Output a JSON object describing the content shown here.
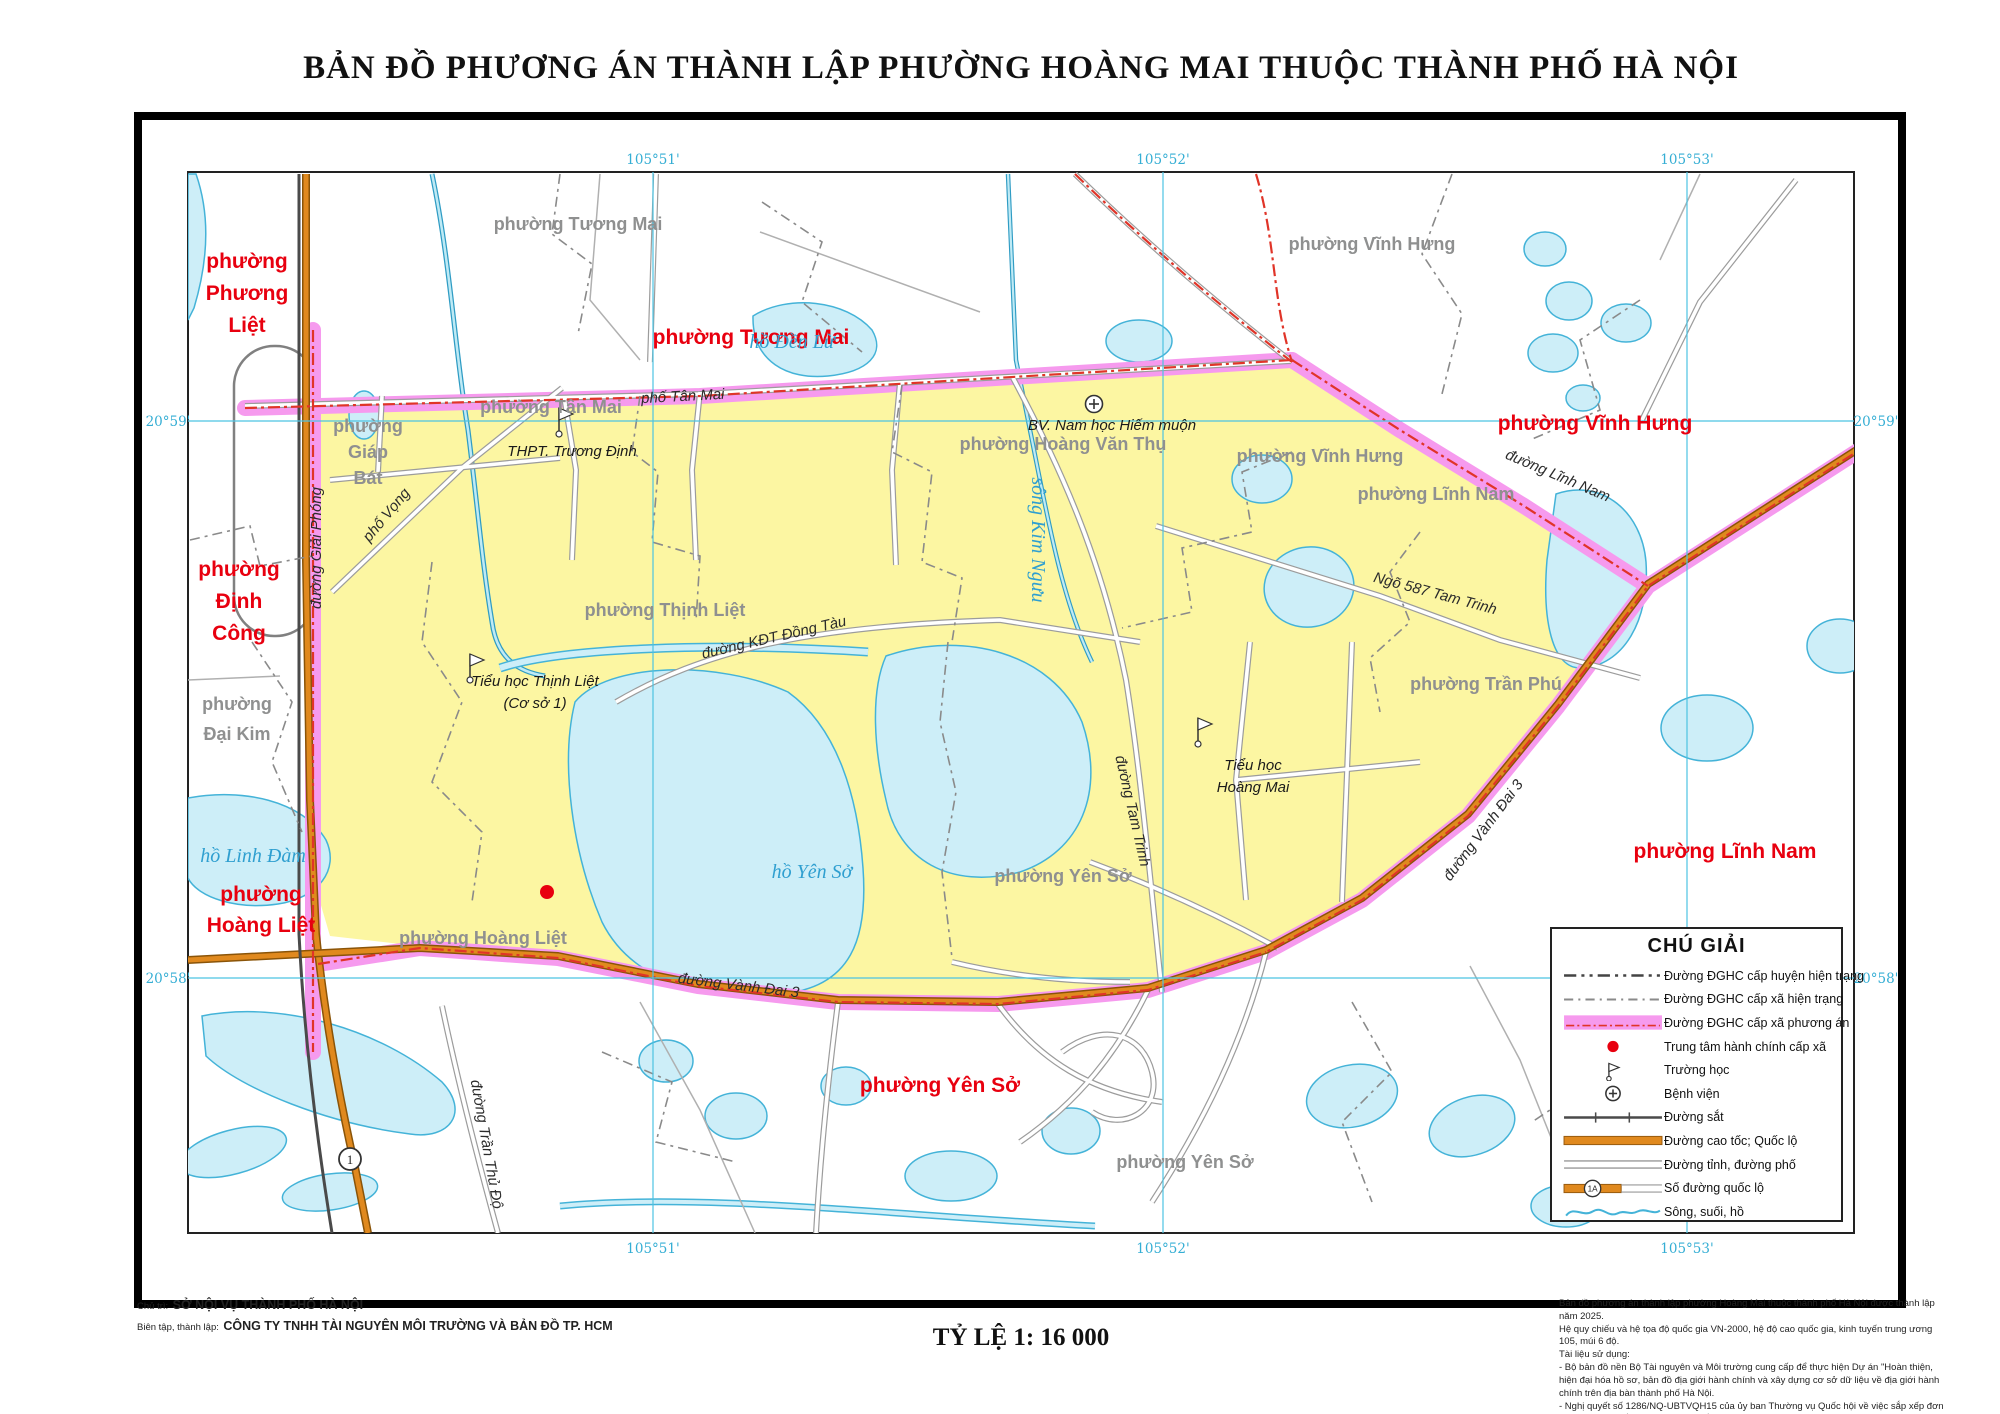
{
  "title": "BẢN ĐỒ PHƯƠNG ÁN THÀNH LẬP PHƯỜNG HOÀNG MAI THUỘC THÀNH PHỐ HÀ NỘI",
  "scale_label": "TỶ LỆ 1: 16 000",
  "credits": {
    "role1_label": "Chủ trì:",
    "role1_value": "SỞ NỘI VỤ THÀNH PHỐ HÀ NỘI",
    "role2_label": "Biên tập, thành lập:",
    "role2_value": "CÔNG TY TNHH TÀI NGUYÊN MÔI TRƯỜNG VÀ BẢN ĐỒ TP. HCM"
  },
  "notes": [
    "Bản đồ phương án thành lập phường Hoàng Mai thuộc thành phố Hà Nội được thành lập năm 2025.",
    "Hệ quy chiếu và hệ tọa độ quốc gia VN-2000, hệ độ cao quốc gia, kinh tuyến trung ương 105, múi 6 độ.",
    "Tài liệu sử dụng:",
    "- Bộ bản đồ nền Bộ Tài nguyên và Môi trường cung cấp để thực hiện Dự án \"Hoàn thiện, hiện đại hóa hồ sơ, bản đồ địa giới hành chính và xây dựng cơ sở dữ liệu về địa giới hành chính trên địa bàn thành phố Hà Nội.",
    "- Nghị quyết số 1286/NQ-UBTVQH15 của ủy ban Thường vụ Quốc hội về việc sắp xếp đơn vị hành chính cấp xã của thành phố Hà Nội giai đoạn 2023 - 2025."
  ],
  "legend": {
    "title": "CHÚ GIẢI",
    "items": [
      {
        "type": "dash_huyen",
        "label": "Đường ĐGHC cấp huyện hiện trạng"
      },
      {
        "type": "dash_xa",
        "label": "Đường ĐGHC cấp xã hiện trạng"
      },
      {
        "type": "pink_band",
        "label": "Đường ĐGHC cấp xã phương án"
      },
      {
        "type": "red_dot",
        "label": "Trung tâm hành chính cấp xã"
      },
      {
        "type": "school",
        "label": "Trường học"
      },
      {
        "type": "hospital",
        "label": "Bệnh viện"
      },
      {
        "type": "railway",
        "label": "Đường sắt"
      },
      {
        "type": "highway",
        "label": "Đường cao tốc; Quốc lộ"
      },
      {
        "type": "street",
        "label": "Đường tỉnh, đường phố"
      },
      {
        "type": "route_badge",
        "label": "Số đường quốc lộ",
        "badge": "1A"
      },
      {
        "type": "water",
        "label": "Sông, suối, hồ"
      }
    ]
  },
  "grid": {
    "lon": [
      {
        "label": "105°51'",
        "x": 653
      },
      {
        "label": "105°52'",
        "x": 1163
      },
      {
        "label": "105°53'",
        "x": 1687
      }
    ],
    "lat": [
      {
        "label": "20°59'",
        "y": 421
      },
      {
        "label": "20°58'",
        "y": 978
      }
    ]
  },
  "map": {
    "labels": {
      "red_wards": [
        {
          "lines": [
            "phường",
            "Phương",
            "Liệt"
          ],
          "x": 247,
          "y": 268,
          "lh": 32
        },
        {
          "text": "phường Tương Mai",
          "x": 751,
          "y": 344
        },
        {
          "text": "phường Vĩnh Hưng",
          "x": 1595,
          "y": 430
        },
        {
          "lines": [
            "phường",
            "Định",
            "Công"
          ],
          "x": 239,
          "y": 576,
          "lh": 32
        },
        {
          "text": "phường Lĩnh Nam",
          "x": 1725,
          "y": 858
        },
        {
          "lines": [
            "phường",
            "Hoàng Liệt"
          ],
          "x": 261,
          "y": 901,
          "lh": 31
        },
        {
          "text": "phường Yên Sở",
          "x": 940,
          "y": 1092
        }
      ],
      "gray_wards": [
        {
          "text": "phường Tương Mai",
          "x": 578,
          "y": 230
        },
        {
          "text": "phường Vĩnh Hưng",
          "x": 1372,
          "y": 250
        },
        {
          "text": "phường Tân Mai",
          "x": 551,
          "y": 413
        },
        {
          "lines": [
            "phường",
            "Giáp",
            "Bát"
          ],
          "x": 368,
          "y": 432,
          "lh": 26
        },
        {
          "text": "phường Hoàng Văn Thụ",
          "x": 1063,
          "y": 450
        },
        {
          "text": "phường Vĩnh Hưng",
          "x": 1320,
          "y": 462
        },
        {
          "text": "phường Lĩnh Nam",
          "x": 1436,
          "y": 500
        },
        {
          "text": "phường Thịnh Liệt",
          "x": 665,
          "y": 616
        },
        {
          "text": "phường Trần Phú",
          "x": 1486,
          "y": 690
        },
        {
          "lines": [
            "phường",
            "Đại Kim"
          ],
          "x": 237,
          "y": 710,
          "lh": 30
        },
        {
          "text": "phường Yên Sở",
          "x": 1063,
          "y": 882
        },
        {
          "text": "phường Hoàng Liệt",
          "x": 483,
          "y": 944
        },
        {
          "text": "phường Yên Sở",
          "x": 1185,
          "y": 1168
        }
      ],
      "water": [
        {
          "text": "hồ Đền Lừ",
          "x": 792,
          "y": 348
        },
        {
          "text": "sông Kim Ngưu",
          "x": 1032,
          "y": 540,
          "r": 90
        },
        {
          "text": "hồ Linh Đàm",
          "x": 253,
          "y": 862
        },
        {
          "text": "hồ Yên Sở",
          "x": 812,
          "y": 878
        }
      ],
      "roads": [
        {
          "text": "phố Tân Mai",
          "x": 683,
          "y": 401,
          "r": -3
        },
        {
          "text": "phố Vọng",
          "x": 390,
          "y": 518,
          "r": -50
        },
        {
          "text": "đường Giải Phóng",
          "x": 321,
          "y": 548,
          "r": -90
        },
        {
          "text": "đường KĐT Đồng Tàu",
          "x": 775,
          "y": 642,
          "r": -13
        },
        {
          "text": "Ngõ 587 Tam Trinh",
          "x": 1434,
          "y": 598,
          "r": 15
        },
        {
          "text": "đường Tam Trinh",
          "x": 1128,
          "y": 812,
          "r": 77
        },
        {
          "text": "đường Lĩnh Nam",
          "x": 1556,
          "y": 480,
          "r": 23
        },
        {
          "text": "đường Vành Đai 3",
          "x": 1487,
          "y": 833,
          "r": -53
        },
        {
          "text": "đường Vành Đai 3",
          "x": 738,
          "y": 990,
          "r": 7
        },
        {
          "text": "đường Trần Thủ Độ",
          "x": 482,
          "y": 1145,
          "r": 80
        }
      ]
    },
    "pois": {
      "schools": [
        {
          "lines": [
            "THPT. Trương Định"
          ],
          "tx": 572,
          "ty": 456,
          "lh": 22,
          "fx": 559,
          "fy": 434
        },
        {
          "lines": [
            "Tiểu học Thịnh Liệt",
            "(Cơ sở 1)"
          ],
          "tx": 535,
          "ty": 686,
          "lh": 22,
          "fx": 470,
          "fy": 680
        },
        {
          "lines": [
            "Tiểu học",
            "Hoàng Mai"
          ],
          "tx": 1253,
          "ty": 770,
          "lh": 22,
          "fx": 1198,
          "fy": 744
        }
      ],
      "hospital": {
        "label": "BV. Nam học Hiếm muộn",
        "tx": 1112,
        "ty": 430,
        "sx": 1094,
        "sy": 404
      },
      "admin_center": {
        "x": 547,
        "y": 892
      },
      "route_badge": {
        "text": "1",
        "x": 350,
        "y": 1159
      }
    },
    "colors": {
      "ward_fill": "#fcf6a2",
      "boundary_pink": "#f69aee",
      "boundary_red": "#e03428",
      "water_fill": "#cdeef8",
      "water_line": "#44b3d8",
      "highway": "#e0891e",
      "red_label": "#e8000f",
      "gray_label": "#8f9090",
      "grid_line": "#4cc3e2"
    }
  }
}
